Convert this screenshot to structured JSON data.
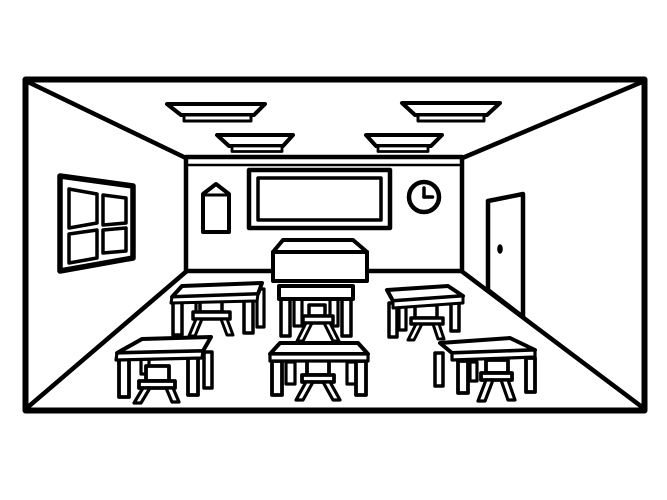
{
  "scene": {
    "description": "Black-and-white coloring-book style line drawing of an empty classroom interior in one-point perspective: back wall with blackboard, poster and clock, window on the left wall, door on the right wall, four ceiling lights, a teacher desk and six student desks with stools",
    "canvas": {
      "width": 667,
      "height": 500
    },
    "palette": {
      "background": "#ffffff",
      "line": "#000000"
    },
    "objects": [
      {
        "name": "outer-border",
        "shape": "rect",
        "x": 25.5,
        "y": 79.5,
        "w": 619,
        "h": 331,
        "stroke_width": 6,
        "fill": "none"
      },
      {
        "name": "ceiling-edge-left",
        "shape": "line",
        "x1": 28,
        "y1": 82,
        "x2": 188,
        "y2": 159,
        "stroke_width": 4.5
      },
      {
        "name": "ceiling-edge-right",
        "shape": "line",
        "x1": 642,
        "y1": 82,
        "x2": 460,
        "y2": 159,
        "stroke_width": 4.5
      },
      {
        "name": "floor-edge-left",
        "shape": "line",
        "x1": 28,
        "y1": 407,
        "x2": 188,
        "y2": 270,
        "stroke_width": 4.5
      },
      {
        "name": "floor-edge-right",
        "shape": "line",
        "x1": 642,
        "y1": 407,
        "x2": 460,
        "y2": 270,
        "stroke_width": 4.5
      },
      {
        "name": "back-wall",
        "shape": "rect",
        "x": 186,
        "y": 157,
        "w": 276,
        "h": 114,
        "stroke_width": 4.5,
        "fill": "white"
      },
      {
        "name": "back-wall-trim-line",
        "shape": "line",
        "x1": 189,
        "y1": 165,
        "x2": 459,
        "y2": 165,
        "stroke_width": 2.5
      },
      {
        "name": "window-frame",
        "shape": "path",
        "d": "M60,176 L133,186 L133,258 L60,271 Z",
        "stroke_width": 5.5,
        "fill": "white"
      },
      {
        "name": "window-pane-top-left",
        "shape": "path",
        "d": "M69,189 L97,194 L97,223 L69,228 Z",
        "stroke_width": 3.5,
        "fill": "white"
      },
      {
        "name": "window-pane-top-right",
        "shape": "path",
        "d": "M103,195 L126,198 L126,223 L103,225 Z",
        "stroke_width": 3.5,
        "fill": "white"
      },
      {
        "name": "window-pane-bottom-left",
        "shape": "path",
        "d": "M69,234 L97,230 L97,258 L69,263 Z",
        "stroke_width": 3.5,
        "fill": "white"
      },
      {
        "name": "window-pane-bottom-right",
        "shape": "path",
        "d": "M103,230 L126,228 L126,251 L103,253 Z",
        "stroke_width": 3.5,
        "fill": "white"
      },
      {
        "name": "poster",
        "shape": "path",
        "d": "M203,194 L216,184 L229,194 L229,232 L203,232 Z",
        "stroke_width": 4,
        "fill": "white"
      },
      {
        "name": "poster-fold-line",
        "shape": "line",
        "x1": 204,
        "y1": 195,
        "x2": 228,
        "y2": 195,
        "stroke_width": 3
      },
      {
        "name": "blackboard-outer-frame",
        "shape": "rect",
        "x": 249,
        "y": 170,
        "w": 141,
        "h": 58,
        "stroke_width": 4.5,
        "fill": "white"
      },
      {
        "name": "blackboard-inner-frame",
        "shape": "rect",
        "x": 258,
        "y": 178,
        "w": 123,
        "h": 42,
        "stroke_width": 3.5,
        "fill": "none"
      },
      {
        "name": "clock-face",
        "shape": "circle",
        "cx": 424,
        "cy": 197,
        "r": 15,
        "stroke_width": 4.5,
        "fill": "white"
      },
      {
        "name": "clock-hour-hand",
        "shape": "line",
        "x1": 424,
        "y1": 197,
        "x2": 424,
        "y2": 188,
        "stroke_width": 3.5
      },
      {
        "name": "clock-minute-hand",
        "shape": "line",
        "x1": 424,
        "y1": 197,
        "x2": 432.5,
        "y2": 197,
        "stroke_width": 3.5
      },
      {
        "name": "door",
        "shape": "path",
        "d": "M488,201 L523,194 L523,317 L488,290 Z",
        "stroke_width": 4.5,
        "fill": "white"
      },
      {
        "name": "door-knob",
        "shape": "ellipse",
        "cx": 500,
        "cy": 249,
        "rx": 2.8,
        "ry": 4.8,
        "fill": "black"
      },
      {
        "name": "ceiling-light-upper-left-shade",
        "shape": "path",
        "d": "M167,104 L265,104 L254,115 L181,115 Z",
        "stroke_width": 4,
        "fill": "white"
      },
      {
        "name": "ceiling-light-upper-left-base",
        "shape": "rect",
        "x": 184,
        "y": 115,
        "w": 67,
        "h": 6,
        "stroke_width": 3,
        "fill": "white"
      },
      {
        "name": "ceiling-light-lower-left-shade",
        "shape": "path",
        "d": "M217,135 L293,135 L283,146 L229,146 Z",
        "stroke_width": 4,
        "fill": "white"
      },
      {
        "name": "ceiling-light-lower-left-base",
        "shape": "rect",
        "x": 232,
        "y": 146,
        "w": 50,
        "h": 5.5,
        "stroke_width": 2.8,
        "fill": "white"
      },
      {
        "name": "ceiling-light-upper-right-shade",
        "shape": "path",
        "d": "M402,103 L500,103 L487,115 L415,115 Z",
        "stroke_width": 4,
        "fill": "white"
      },
      {
        "name": "ceiling-light-upper-right-base",
        "shape": "rect",
        "x": 418,
        "y": 115,
        "w": 66,
        "h": 6,
        "stroke_width": 3,
        "fill": "white"
      },
      {
        "name": "ceiling-light-lower-right-shade",
        "shape": "path",
        "d": "M366,135 L442,135 L431,146 L376,146 Z",
        "stroke_width": 4,
        "fill": "white"
      },
      {
        "name": "ceiling-light-lower-right-base",
        "shape": "rect",
        "x": 378,
        "y": 146,
        "w": 50,
        "h": 5.5,
        "stroke_width": 2.8,
        "fill": "white"
      },
      {
        "name": "teacher-desk-top",
        "shape": "path",
        "d": "M283,240 L353,240 L367,252 L273,252 Z",
        "stroke_width": 4,
        "fill": "white"
      },
      {
        "name": "teacher-desk-front",
        "shape": "rect",
        "x": 273,
        "y": 252,
        "w": 94,
        "h": 29,
        "stroke_width": 4,
        "fill": "white"
      },
      {
        "name": "desk-back-left-rear-leg-left",
        "shape": "rect",
        "x": 196,
        "y": 299,
        "w": 7,
        "h": 18,
        "stroke_width": 3.2,
        "fill": "white"
      },
      {
        "name": "desk-back-left-rear-leg-right",
        "shape": "rect",
        "x": 257,
        "y": 289,
        "w": 7,
        "h": 38,
        "stroke_width": 3.2,
        "fill": "white"
      },
      {
        "name": "desk-back-left-stool-back",
        "shape": "rect",
        "x": 200,
        "y": 298,
        "w": 22,
        "h": 14,
        "stroke_width": 3.5,
        "fill": "white"
      },
      {
        "name": "desk-back-left-stool-seat",
        "shape": "rect",
        "x": 193,
        "y": 312,
        "w": 37,
        "h": 7,
        "stroke_width": 3.5,
        "fill": "white"
      },
      {
        "name": "desk-back-left-stool-leg-left",
        "shape": "path",
        "d": "M196,319 L202,319 L195,336 L189,336 Z",
        "stroke_width": 3,
        "fill": "white"
      },
      {
        "name": "desk-back-left-stool-leg-right",
        "shape": "path",
        "d": "M221,319 L227,319 L233,335 L227,335 Z",
        "stroke_width": 3,
        "fill": "white"
      },
      {
        "name": "desk-back-left-front-leg-left",
        "shape": "rect",
        "x": 173,
        "y": 299,
        "w": 9,
        "h": 36,
        "stroke_width": 3.5,
        "fill": "white"
      },
      {
        "name": "desk-back-left-front-leg-right",
        "shape": "rect",
        "x": 244,
        "y": 297,
        "w": 9,
        "h": 36,
        "stroke_width": 3.5,
        "fill": "white"
      },
      {
        "name": "desk-back-left-tabletop",
        "shape": "path",
        "d": "M182,286 L262,283 L258,294 L172,297 Z",
        "stroke_width": 4,
        "fill": "white"
      },
      {
        "name": "desk-back-left-tabletop-edge",
        "shape": "path",
        "d": "M172,297 L258,294 L257,301 L171,303 Z",
        "stroke_width": 3,
        "fill": "white"
      },
      {
        "name": "desk-back-center-rear-leg-left",
        "shape": "rect",
        "x": 294,
        "y": 299,
        "w": 8,
        "h": 27,
        "stroke_width": 3.2,
        "fill": "white"
      },
      {
        "name": "desk-back-center-rear-leg-right",
        "shape": "rect",
        "x": 330,
        "y": 299,
        "w": 8,
        "h": 27,
        "stroke_width": 3.2,
        "fill": "white"
      },
      {
        "name": "desk-back-center-stool-back",
        "shape": "rect",
        "x": 309,
        "y": 305,
        "w": 16,
        "h": 11,
        "stroke_width": 3.5,
        "fill": "white"
      },
      {
        "name": "desk-back-center-stool-seat",
        "shape": "rect",
        "x": 303,
        "y": 316,
        "w": 30,
        "h": 7,
        "stroke_width": 3.5,
        "fill": "white"
      },
      {
        "name": "desk-back-center-stool-leg-left",
        "shape": "path",
        "d": "M306,323 L312,323 L303,341 L297,341 Z",
        "stroke_width": 3,
        "fill": "white"
      },
      {
        "name": "desk-back-center-stool-leg-right",
        "shape": "path",
        "d": "M324,323 L330,323 L339,341 L333,341 Z",
        "stroke_width": 3,
        "fill": "white"
      },
      {
        "name": "desk-back-center-front-leg-left",
        "shape": "rect",
        "x": 281,
        "y": 298,
        "w": 9,
        "h": 38,
        "stroke_width": 3.5,
        "fill": "white"
      },
      {
        "name": "desk-back-center-front-leg-right",
        "shape": "rect",
        "x": 342,
        "y": 298,
        "w": 9,
        "h": 38,
        "stroke_width": 3.5,
        "fill": "white"
      },
      {
        "name": "desk-back-center-tabletop",
        "shape": "rect",
        "x": 279,
        "y": 286,
        "w": 74,
        "h": 13,
        "stroke_width": 4,
        "fill": "white"
      },
      {
        "name": "desk-back-right-rear-leg-left",
        "shape": "rect",
        "x": 399,
        "y": 302,
        "w": 7,
        "h": 28,
        "stroke_width": 3.2,
        "fill": "white"
      },
      {
        "name": "desk-back-right-stool-back",
        "shape": "rect",
        "x": 415,
        "y": 305,
        "w": 22,
        "h": 13,
        "stroke_width": 3.5,
        "fill": "white"
      },
      {
        "name": "desk-back-right-stool-seat",
        "shape": "rect",
        "x": 411,
        "y": 318,
        "w": 32,
        "h": 6,
        "stroke_width": 3.5,
        "fill": "white"
      },
      {
        "name": "desk-back-right-stool-leg-left",
        "shape": "path",
        "d": "M416,324 L422,324 L414,340 L408,340 Z",
        "stroke_width": 3,
        "fill": "white"
      },
      {
        "name": "desk-back-right-stool-leg-right",
        "shape": "path",
        "d": "M433,324 L439,324 L444,339 L438,339 Z",
        "stroke_width": 3,
        "fill": "white"
      },
      {
        "name": "desk-back-right-front-leg-left",
        "shape": "rect",
        "x": 389,
        "y": 303,
        "w": 8,
        "h": 34,
        "stroke_width": 3.5,
        "fill": "white"
      },
      {
        "name": "desk-back-right-front-leg-right",
        "shape": "rect",
        "x": 451,
        "y": 298,
        "w": 8,
        "h": 33,
        "stroke_width": 3.5,
        "fill": "white"
      },
      {
        "name": "desk-back-right-tabletop",
        "shape": "path",
        "d": "M387,290 L448,286 L463,296 L393,301 Z",
        "stroke_width": 4,
        "fill": "white"
      },
      {
        "name": "desk-back-right-tabletop-edge",
        "shape": "path",
        "d": "M393,301 L463,296 L463,303 L393,308 Z",
        "stroke_width": 3,
        "fill": "white"
      },
      {
        "name": "desk-front-left-rear-leg-left",
        "shape": "rect",
        "x": 141,
        "y": 357,
        "w": 8,
        "h": 17,
        "stroke_width": 3.2,
        "fill": "white"
      },
      {
        "name": "desk-front-left-rear-leg-right",
        "shape": "rect",
        "x": 204,
        "y": 352,
        "w": 8,
        "h": 36,
        "stroke_width": 3.5,
        "fill": "white"
      },
      {
        "name": "desk-front-left-stool-back",
        "shape": "rect",
        "x": 146,
        "y": 366,
        "w": 23,
        "h": 15,
        "stroke_width": 3.8,
        "fill": "white"
      },
      {
        "name": "desk-front-left-stool-seat",
        "shape": "rect",
        "x": 139,
        "y": 381,
        "w": 36,
        "h": 7,
        "stroke_width": 3.8,
        "fill": "white"
      },
      {
        "name": "desk-front-left-stool-leg-left",
        "shape": "path",
        "d": "M143,388 L150,388 L141,403 L134,403 Z",
        "stroke_width": 3.2,
        "fill": "white"
      },
      {
        "name": "desk-front-left-stool-leg-right",
        "shape": "path",
        "d": "M166,388 L173,388 L179,402 L172,402 Z",
        "stroke_width": 3.2,
        "fill": "white"
      },
      {
        "name": "desk-front-left-front-leg-left",
        "shape": "rect",
        "x": 119,
        "y": 357,
        "w": 10,
        "h": 40,
        "stroke_width": 3.8,
        "fill": "white"
      },
      {
        "name": "desk-front-left-front-leg-right",
        "shape": "rect",
        "x": 188,
        "y": 355,
        "w": 10,
        "h": 40,
        "stroke_width": 3.8,
        "fill": "white"
      },
      {
        "name": "desk-front-left-tabletop",
        "shape": "path",
        "d": "M142,339 L211,337 L203,351 L117,353 Z",
        "stroke_width": 4,
        "fill": "white"
      },
      {
        "name": "desk-front-left-tabletop-edge",
        "shape": "path",
        "d": "M117,353 L203,351 L202,358 L116,360 Z",
        "stroke_width": 3.2,
        "fill": "white"
      },
      {
        "name": "desk-front-center-rear-leg-left",
        "shape": "rect",
        "x": 286,
        "y": 362,
        "w": 9,
        "h": 22,
        "stroke_width": 3.2,
        "fill": "white"
      },
      {
        "name": "desk-front-center-rear-leg-right",
        "shape": "rect",
        "x": 347,
        "y": 362,
        "w": 9,
        "h": 22,
        "stroke_width": 3.2,
        "fill": "white"
      },
      {
        "name": "desk-front-center-stool-back",
        "shape": "rect",
        "x": 307,
        "y": 356,
        "w": 22,
        "h": 19,
        "stroke_width": 3.8,
        "fill": "white"
      },
      {
        "name": "desk-front-center-stool-seat",
        "shape": "rect",
        "x": 302,
        "y": 375,
        "w": 32,
        "h": 7,
        "stroke_width": 3.8,
        "fill": "white"
      },
      {
        "name": "desk-front-center-stool-leg-left",
        "shape": "path",
        "d": "M306,382 L313,382 L303,400 L296,400 Z",
        "stroke_width": 3.2,
        "fill": "white"
      },
      {
        "name": "desk-front-center-stool-leg-right",
        "shape": "path",
        "d": "M323,382 L330,382 L340,400 L333,400 Z",
        "stroke_width": 3.2,
        "fill": "white"
      },
      {
        "name": "desk-front-center-front-leg-left",
        "shape": "rect",
        "x": 272,
        "y": 361,
        "w": 10,
        "h": 34,
        "stroke_width": 3.8,
        "fill": "white"
      },
      {
        "name": "desk-front-center-front-leg-right",
        "shape": "rect",
        "x": 356,
        "y": 361,
        "w": 10,
        "h": 34,
        "stroke_width": 3.8,
        "fill": "white"
      },
      {
        "name": "desk-front-center-tabletop",
        "shape": "path",
        "d": "M280,343 L358,343 L368,354 L270,354 Z",
        "stroke_width": 4,
        "fill": "white"
      },
      {
        "name": "desk-front-center-tabletop-edge",
        "shape": "path",
        "d": "M270,354 L368,354 L368,361 L270,361 Z",
        "stroke_width": 3.2,
        "fill": "white"
      },
      {
        "name": "desk-front-right-rear-leg-left",
        "shape": "rect",
        "x": 435,
        "y": 353,
        "w": 8,
        "h": 33,
        "stroke_width": 3.5,
        "fill": "white"
      },
      {
        "name": "desk-front-right-rear-leg-mid",
        "shape": "rect",
        "x": 470,
        "y": 362,
        "w": 7,
        "h": 19,
        "stroke_width": 3.2,
        "fill": "white"
      },
      {
        "name": "desk-front-right-stool-back",
        "shape": "rect",
        "x": 486,
        "y": 360,
        "w": 22,
        "h": 13,
        "stroke_width": 3.8,
        "fill": "white"
      },
      {
        "name": "desk-front-right-stool-seat",
        "shape": "rect",
        "x": 481,
        "y": 373,
        "w": 31,
        "h": 7,
        "stroke_width": 3.8,
        "fill": "white"
      },
      {
        "name": "desk-front-right-stool-leg-left",
        "shape": "path",
        "d": "M486,380 L493,380 L485,401 L478,401 Z",
        "stroke_width": 3.2,
        "fill": "white"
      },
      {
        "name": "desk-front-right-stool-leg-right",
        "shape": "path",
        "d": "M501,380 L508,380 L515,400 L508,400 Z",
        "stroke_width": 3.2,
        "fill": "white"
      },
      {
        "name": "desk-front-right-front-leg-left",
        "shape": "rect",
        "x": 458,
        "y": 361,
        "w": 10,
        "h": 32,
        "stroke_width": 3.8,
        "fill": "white"
      },
      {
        "name": "desk-front-right-front-leg-right",
        "shape": "rect",
        "x": 526,
        "y": 358,
        "w": 9,
        "h": 34,
        "stroke_width": 3.8,
        "fill": "white"
      },
      {
        "name": "desk-front-right-tabletop",
        "shape": "path",
        "d": "M440,343 L510,338 L535,350 L452,353 Z",
        "stroke_width": 4,
        "fill": "white"
      },
      {
        "name": "desk-front-right-tabletop-edge",
        "shape": "path",
        "d": "M452,353 L535,350 L535,357 L452,360 Z",
        "stroke_width": 3.2,
        "fill": "white"
      }
    ]
  }
}
